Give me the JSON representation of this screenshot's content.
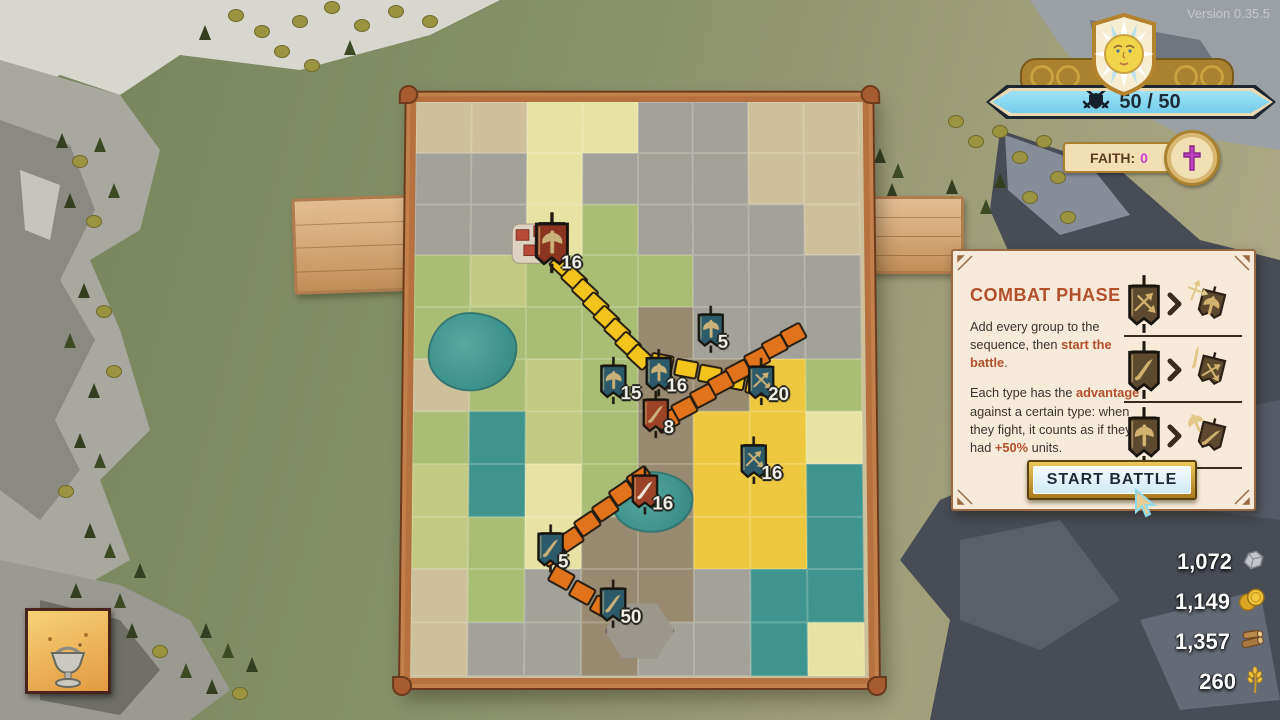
{
  "version": "Version 0.35.5",
  "hud": {
    "capacity": {
      "value": "50 / 50",
      "icon": "crossed-swords-shield",
      "bar_color": "#74cdeb"
    },
    "faith": {
      "label": "FAITH:",
      "value": "0",
      "value_color": "#cc3fcc",
      "icon": "cross"
    }
  },
  "combat_panel": {
    "title": "COMBAT PHASE",
    "p1": [
      {
        "t": "Add every group to the sequence, then "
      },
      {
        "t": "start the battle",
        "b": true
      },
      {
        "t": "."
      }
    ],
    "p2": [
      {
        "t": "Each type has the "
      },
      {
        "t": "advantage",
        "b": true
      },
      {
        "t": " against a certain type: when they fight, it counts as if they had "
      },
      {
        "t": "+50%",
        "b": true
      },
      {
        "t": " units."
      }
    ],
    "matchups": [
      {
        "winner": "arrows",
        "loser": "axe"
      },
      {
        "winner": "sword",
        "loser": "arrows"
      },
      {
        "winner": "axe",
        "loser": "sword"
      }
    ],
    "button_label": "START BATTLE"
  },
  "resources": [
    {
      "name": "stone",
      "amount": "1,072"
    },
    {
      "name": "gold",
      "amount": "1,149"
    },
    {
      "name": "wood",
      "amount": "1,357"
    },
    {
      "name": "wheat",
      "amount": "260"
    }
  ],
  "map": {
    "banners": [
      {
        "icon": "axe",
        "color": "#8a3520",
        "count": "16",
        "x": 30.5,
        "y": 26.3,
        "big": true
      },
      {
        "icon": "axe",
        "color": "#2d5a68",
        "count": "15",
        "x": 44.2,
        "y": 50.2
      },
      {
        "icon": "axe",
        "color": "#2d5a68",
        "count": "16",
        "x": 54.3,
        "y": 48.9
      },
      {
        "icon": "axe",
        "color": "#2d5a68",
        "count": "5",
        "x": 65.7,
        "y": 41.2
      },
      {
        "icon": "arrows",
        "color": "#2d5a68",
        "count": "20",
        "x": 76.8,
        "y": 50.4
      },
      {
        "icon": "sword",
        "color": "#9c4226",
        "count": "8",
        "x": 53.7,
        "y": 56.1
      },
      {
        "icon": "arrows",
        "color": "#2d5a68",
        "count": "16",
        "x": 75.2,
        "y": 64.0
      },
      {
        "icon": "sword",
        "color": "#9c4226",
        "glyph": "#ece6da",
        "count": "16",
        "x": 51.2,
        "y": 69.2
      },
      {
        "icon": "sword",
        "color": "#2d5a68",
        "count": "5",
        "x": 30.5,
        "y": 79.2
      },
      {
        "icon": "sword",
        "color": "#2d5a68",
        "count": "50",
        "x": 44.2,
        "y": 88.6
      }
    ],
    "paths": [
      {
        "color": "#f2c41e",
        "from": [
          33,
          29
        ],
        "to": [
          50,
          45
        ],
        "n": 8
      },
      {
        "color": "#f2c41e",
        "from": [
          55,
          46
        ],
        "to": [
          76,
          50
        ],
        "n": 5
      },
      {
        "color": "#e0731c",
        "from": [
          84,
          41
        ],
        "to": [
          56,
          56
        ],
        "n": 8
      },
      {
        "color": "#e0731c",
        "from": [
          50,
          66
        ],
        "to": [
          31,
          79
        ],
        "n": 6
      },
      {
        "color": "#e0731c",
        "from": [
          33,
          83
        ],
        "to": [
          42,
          88
        ],
        "n": 3
      }
    ],
    "tiles": [
      "ttyyrrtt",
      "rryrrrtt",
      "rrygrrrt",
      "ghgggrrr",
      "ggggvrrr",
      "tghgvvfg",
      "gwhgvffy",
      "hwygvffw",
      "hgyvvffw",
      "tgrvvrww",
      "trrvrrwy"
    ],
    "tile_colors": {
      "t": "#cdc09a",
      "g": "#a9bd74",
      "h": "#c3ca83",
      "y": "#e7e3a5",
      "f": "#edc83e",
      "r": "#a3a29a",
      "w": "#3f948e",
      "v": "#988a70",
      "c": "#a9bd74"
    },
    "props": [
      {
        "type": "lake",
        "x": 13,
        "y": 44,
        "w": 19,
        "h": 13
      },
      {
        "type": "lake",
        "x": 53,
        "y": 70,
        "w": 17,
        "h": 10
      },
      {
        "type": "castle",
        "x": 27,
        "y": 25
      },
      {
        "type": "fort",
        "x": 50,
        "y": 92
      }
    ]
  },
  "scenery": {
    "trees": [
      [
        62,
        148,
        0
      ],
      [
        80,
        168,
        2
      ],
      [
        100,
        152,
        1
      ],
      [
        70,
        208,
        0
      ],
      [
        94,
        228,
        2
      ],
      [
        114,
        198,
        1
      ],
      [
        84,
        298,
        0
      ],
      [
        104,
        318,
        2
      ],
      [
        70,
        348,
        1
      ],
      [
        94,
        398,
        0
      ],
      [
        114,
        378,
        2
      ],
      [
        80,
        448,
        0
      ],
      [
        100,
        468,
        1
      ],
      [
        66,
        498,
        2
      ],
      [
        90,
        538,
        0
      ],
      [
        110,
        558,
        1
      ],
      [
        76,
        598,
        0
      ],
      [
        96,
        622,
        2
      ],
      [
        120,
        608,
        1
      ],
      [
        140,
        578,
        0
      ],
      [
        132,
        638,
        0
      ],
      [
        160,
        658,
        2
      ],
      [
        186,
        678,
        1
      ],
      [
        212,
        694,
        0
      ],
      [
        240,
        700,
        2
      ],
      [
        236,
        22,
        2
      ],
      [
        262,
        38,
        2
      ],
      [
        300,
        28,
        2
      ],
      [
        332,
        14,
        2
      ],
      [
        362,
        32,
        2
      ],
      [
        396,
        18,
        2
      ],
      [
        430,
        28,
        2
      ],
      [
        282,
        58,
        2
      ],
      [
        312,
        72,
        2
      ],
      [
        205,
        40,
        0
      ],
      [
        350,
        55,
        1
      ],
      [
        956,
        128,
        2
      ],
      [
        976,
        148,
        2
      ],
      [
        1000,
        138,
        2
      ],
      [
        1020,
        164,
        2
      ],
      [
        1044,
        148,
        2
      ],
      [
        1000,
        188,
        0
      ],
      [
        1030,
        204,
        2
      ],
      [
        1058,
        184,
        2
      ],
      [
        986,
        214,
        1
      ],
      [
        952,
        194,
        0
      ],
      [
        1068,
        224,
        2
      ],
      [
        880,
        163,
        0
      ],
      [
        898,
        178,
        1
      ],
      [
        892,
        198,
        0
      ],
      [
        206,
        638,
        0
      ],
      [
        228,
        658,
        1
      ],
      [
        252,
        672,
        0
      ]
    ]
  }
}
